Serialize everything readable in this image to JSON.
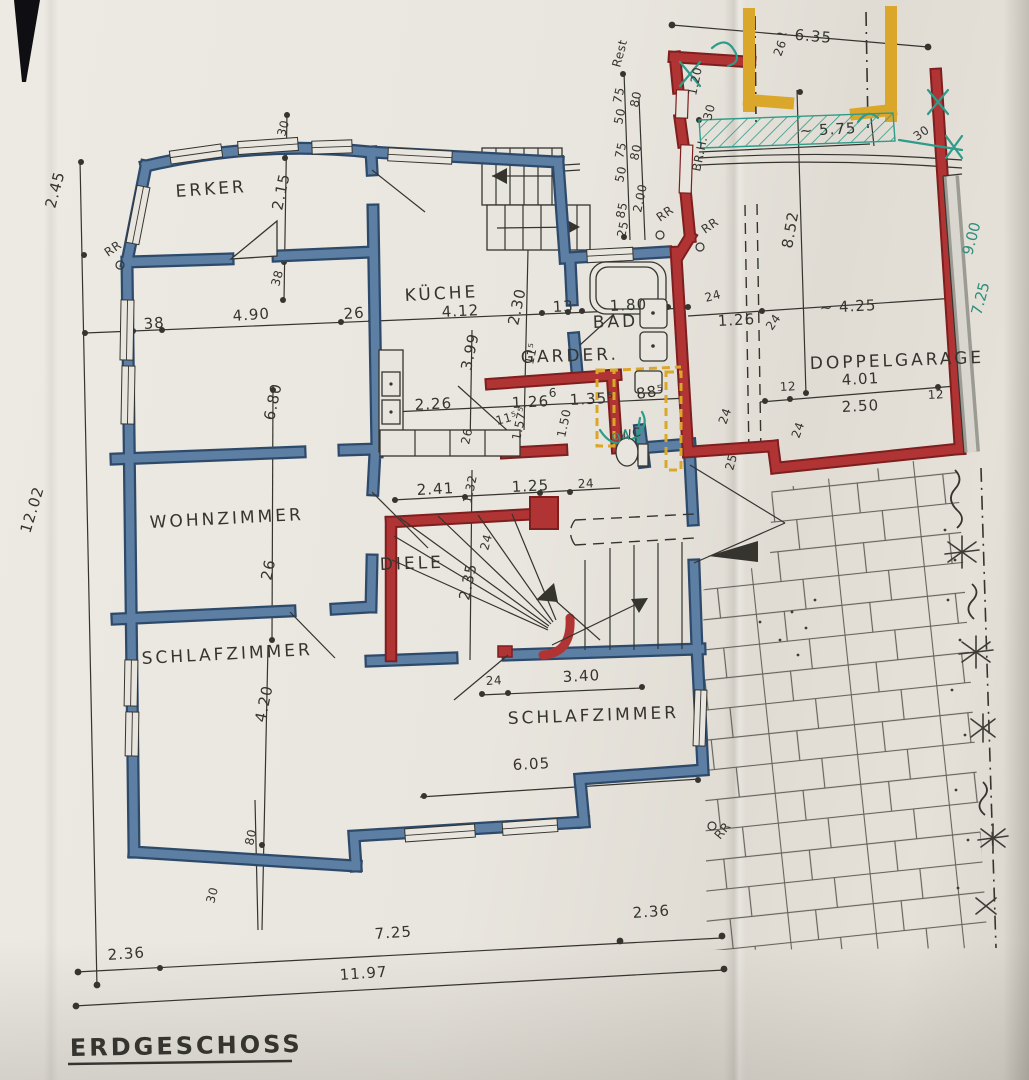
{
  "title": {
    "text": "ERDGESCHOSS"
  },
  "palette": {
    "paper": "#e8e5de",
    "ink": "#35342f",
    "blue": "#5d7fa3",
    "blue_dark": "#2e4a6b",
    "red": "#b13434",
    "red_dark": "#7e1f1f",
    "yellow": "#dba72b",
    "teal": "#2f9b8a",
    "green_pen": "#2e8f7f",
    "gray": "#9b9b94"
  },
  "rooms": [
    "ERKER",
    "KÜCHE",
    "BAD",
    "GARDER.",
    "WC",
    "WOHNZIMMER",
    "DIELE",
    "SCHLAFZIMMER",
    "SCHLAFZIMMER",
    "DOPPELGARAGE"
  ],
  "labels": [
    {
      "t": "ERKER",
      "x": 176,
      "y": 197,
      "r": -4,
      "c": "room"
    },
    {
      "t": "KÜCHE",
      "x": 405,
      "y": 301,
      "r": -3,
      "c": "room"
    },
    {
      "t": "BAD",
      "x": 593,
      "y": 328,
      "r": -2,
      "c": "room"
    },
    {
      "t": "GARDER.",
      "x": 521,
      "y": 363,
      "r": -2,
      "c": "room"
    },
    {
      "t": "WC",
      "x": 621,
      "y": 440,
      "r": -12,
      "c": "small"
    },
    {
      "t": "WOHNZIMMER",
      "x": 150,
      "y": 528,
      "r": -3,
      "c": "room"
    },
    {
      "t": "DIELE",
      "x": 380,
      "y": 570,
      "r": -2,
      "c": "room"
    },
    {
      "t": "SCHLAFZIMMER",
      "x": 142,
      "y": 664,
      "r": -3,
      "c": "room"
    },
    {
      "t": "SCHLAFZIMMER",
      "x": 508,
      "y": 724,
      "r": -2,
      "c": "room"
    },
    {
      "t": "DOPPELGARAGE",
      "x": 810,
      "y": 369,
      "r": -2,
      "c": "room"
    },
    {
      "t": "~ 6.35",
      "x": 775,
      "y": 38,
      "r": 5,
      "c": "dim"
    },
    {
      "t": "26",
      "x": 781,
      "y": 57,
      "r": -70,
      "c": "small"
    },
    {
      "t": "~ 5.75",
      "x": 800,
      "y": 136,
      "r": -3,
      "c": "dim"
    },
    {
      "t": "30",
      "x": 711,
      "y": 121,
      "r": -75,
      "c": "small"
    },
    {
      "t": "1.20",
      "x": 696,
      "y": 96,
      "r": -78,
      "c": "small"
    },
    {
      "t": "BR.H.",
      "x": 700,
      "y": 172,
      "r": -78,
      "c": "small"
    },
    {
      "t": "30",
      "x": 917,
      "y": 141,
      "r": -35,
      "c": "small"
    },
    {
      "t": "Rest",
      "x": 620,
      "y": 68,
      "r": -75,
      "c": "small"
    },
    {
      "t": "75",
      "x": 621,
      "y": 104,
      "r": -78,
      "c": "small"
    },
    {
      "t": "50",
      "x": 622,
      "y": 125,
      "r": -78,
      "c": "small"
    },
    {
      "t": "75",
      "x": 623,
      "y": 159,
      "r": -78,
      "c": "small"
    },
    {
      "t": "50",
      "x": 623,
      "y": 183,
      "r": -78,
      "c": "small"
    },
    {
      "t": "85",
      "x": 624,
      "y": 219,
      "r": -78,
      "c": "small"
    },
    {
      "t": "25",
      "x": 625,
      "y": 238,
      "r": -78,
      "c": "small"
    },
    {
      "t": "80",
      "x": 638,
      "y": 108,
      "r": -78,
      "c": "small"
    },
    {
      "t": "80",
      "x": 638,
      "y": 161,
      "r": -78,
      "c": "small"
    },
    {
      "t": "2.00",
      "x": 641,
      "y": 213,
      "r": -78,
      "c": "small"
    },
    {
      "t": "RR",
      "x": 660,
      "y": 222,
      "r": -35,
      "c": "small"
    },
    {
      "t": "RR",
      "x": 705,
      "y": 234,
      "r": -35,
      "c": "small"
    },
    {
      "t": "38",
      "x": 144,
      "y": 329,
      "r": -4,
      "c": "dim"
    },
    {
      "t": "4.90",
      "x": 233,
      "y": 321,
      "r": -4,
      "c": "dim"
    },
    {
      "t": "26",
      "x": 344,
      "y": 319,
      "r": -4,
      "c": "dim"
    },
    {
      "t": "4.12",
      "x": 442,
      "y": 317,
      "r": -3,
      "c": "dim"
    },
    {
      "t": "2.30",
      "x": 518,
      "y": 326,
      "r": -78,
      "c": "dim"
    },
    {
      "t": "13",
      "x": 553,
      "y": 312,
      "r": -3,
      "c": "dim"
    },
    {
      "t": "1.80",
      "x": 610,
      "y": 311,
      "r": -3,
      "c": "dim"
    },
    {
      "t": "24",
      "x": 706,
      "y": 302,
      "r": -15,
      "c": "small"
    },
    {
      "t": "1.26",
      "x": 718,
      "y": 326,
      "r": -3,
      "c": "dim"
    },
    {
      "t": "24",
      "x": 772,
      "y": 331,
      "r": -55,
      "c": "small"
    },
    {
      "t": "~ 4.25",
      "x": 820,
      "y": 313,
      "r": -3,
      "c": "dim"
    },
    {
      "t": "30",
      "x": 285,
      "y": 137,
      "r": -75,
      "c": "small"
    },
    {
      "t": "2.15",
      "x": 282,
      "y": 211,
      "r": -78,
      "c": "dim"
    },
    {
      "t": "38",
      "x": 279,
      "y": 287,
      "r": -75,
      "c": "small"
    },
    {
      "t": "RR",
      "x": 108,
      "y": 257,
      "r": -35,
      "c": "small"
    },
    {
      "t": "2.45",
      "x": 55,
      "y": 209,
      "r": -75,
      "c": "dim"
    },
    {
      "t": "12.02",
      "x": 30,
      "y": 534,
      "r": -73,
      "c": "dim"
    },
    {
      "t": "3.99",
      "x": 471,
      "y": 371,
      "r": -78,
      "c": "dim"
    },
    {
      "t": "11⁵",
      "x": 533,
      "y": 365,
      "r": -78,
      "c": "small"
    },
    {
      "t": "2.26",
      "x": 415,
      "y": 410,
      "r": -3,
      "c": "dim"
    },
    {
      "t": "1.26",
      "x": 512,
      "y": 408,
      "r": -3,
      "c": "dim"
    },
    {
      "t": "6",
      "x": 549,
      "y": 397,
      "r": -3,
      "c": "small"
    },
    {
      "t": "1.35⁵",
      "x": 570,
      "y": 405,
      "r": -3,
      "c": "dim"
    },
    {
      "t": "88⁵",
      "x": 637,
      "y": 399,
      "r": -8,
      "c": "dim"
    },
    {
      "t": "11⁵",
      "x": 497,
      "y": 425,
      "r": -15,
      "c": "small"
    },
    {
      "t": "1.57⁵",
      "x": 520,
      "y": 441,
      "r": -78,
      "c": "small"
    },
    {
      "t": "1.50",
      "x": 565,
      "y": 438,
      "r": -78,
      "c": "small"
    },
    {
      "t": "26",
      "x": 469,
      "y": 445,
      "r": -78,
      "c": "small"
    },
    {
      "t": "94",
      "x": 614,
      "y": 445,
      "r": -20,
      "c": "green"
    },
    {
      "t": "6.80",
      "x": 274,
      "y": 421,
      "r": -78,
      "c": "dim"
    },
    {
      "t": "26",
      "x": 271,
      "y": 581,
      "r": -78,
      "c": "dim"
    },
    {
      "t": "2.41",
      "x": 417,
      "y": 495,
      "r": -3,
      "c": "dim"
    },
    {
      "t": "1.32",
      "x": 471,
      "y": 504,
      "r": -78,
      "c": "small"
    },
    {
      "t": "1.25",
      "x": 512,
      "y": 492,
      "r": -3,
      "c": "dim"
    },
    {
      "t": "24",
      "x": 578,
      "y": 488,
      "r": -3,
      "c": "small"
    },
    {
      "t": "24",
      "x": 488,
      "y": 551,
      "r": -75,
      "c": "small"
    },
    {
      "t": "2.35",
      "x": 469,
      "y": 601,
      "r": -78,
      "c": "dim"
    },
    {
      "t": "4.20",
      "x": 265,
      "y": 723,
      "r": -78,
      "c": "dim"
    },
    {
      "t": "80",
      "x": 253,
      "y": 846,
      "r": -78,
      "c": "small"
    },
    {
      "t": "30",
      "x": 214,
      "y": 904,
      "r": -75,
      "c": "small"
    },
    {
      "t": "24",
      "x": 486,
      "y": 685,
      "r": -3,
      "c": "small"
    },
    {
      "t": "3.40",
      "x": 563,
      "y": 682,
      "r": -3,
      "c": "dim"
    },
    {
      "t": "6.05",
      "x": 513,
      "y": 770,
      "r": -3,
      "c": "dim"
    },
    {
      "t": "RR",
      "x": 720,
      "y": 840,
      "r": -50,
      "c": "small"
    },
    {
      "t": "2.36",
      "x": 108,
      "y": 960,
      "r": -4,
      "c": "dim"
    },
    {
      "t": "7.25",
      "x": 375,
      "y": 939,
      "r": -4,
      "c": "dim"
    },
    {
      "t": "2.36",
      "x": 633,
      "y": 918,
      "r": -4,
      "c": "dim"
    },
    {
      "t": "11.97",
      "x": 340,
      "y": 980,
      "r": -4,
      "c": "dim"
    },
    {
      "t": "8.52",
      "x": 792,
      "y": 249,
      "r": -80,
      "c": "dim"
    },
    {
      "t": "12",
      "x": 780,
      "y": 391,
      "r": -3,
      "c": "small"
    },
    {
      "t": "4.01",
      "x": 842,
      "y": 385,
      "r": -3,
      "c": "dim"
    },
    {
      "t": "2.50",
      "x": 842,
      "y": 412,
      "r": -3,
      "c": "dim"
    },
    {
      "t": "12",
      "x": 928,
      "y": 399,
      "r": -3,
      "c": "small"
    },
    {
      "t": "24",
      "x": 726,
      "y": 425,
      "r": -70,
      "c": "small"
    },
    {
      "t": "24",
      "x": 799,
      "y": 439,
      "r": -70,
      "c": "small"
    },
    {
      "t": "25",
      "x": 733,
      "y": 471,
      "r": -75,
      "c": "small"
    },
    {
      "t": "9.00",
      "x": 972,
      "y": 256,
      "r": -75,
      "c": "green"
    },
    {
      "t": "7.25",
      "x": 981,
      "y": 316,
      "r": -75,
      "c": "green"
    }
  ]
}
